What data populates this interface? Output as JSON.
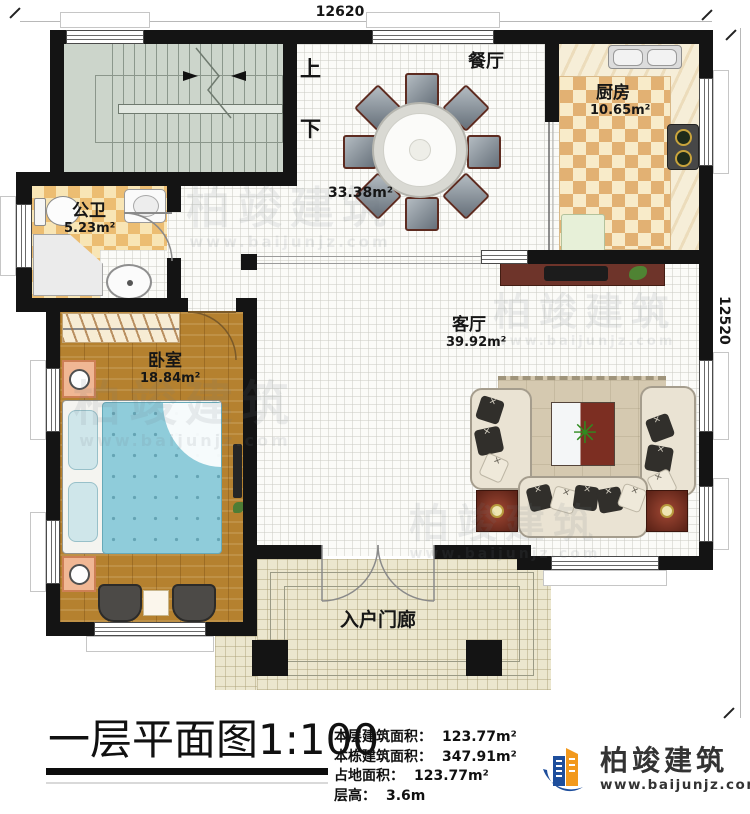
{
  "plan": {
    "dimensions": {
      "top": "12620",
      "right": "12520"
    },
    "stairs": {
      "up": "上",
      "down": "下"
    },
    "rooms": {
      "dining": {
        "name": "餐厅",
        "area": "33.38m²"
      },
      "kitchen": {
        "name": "厨房",
        "area": "10.65m²"
      },
      "bathroom": {
        "name": "公卫",
        "area": "5.23m²"
      },
      "bedroom": {
        "name": "卧室",
        "area": "18.84m²"
      },
      "living": {
        "name": "客厅",
        "area": "39.92m²"
      },
      "porch": {
        "name": "入户门廊"
      }
    }
  },
  "titleblock": {
    "title": "一层平面图",
    "scale": "1:100",
    "stats": [
      {
        "label": "本层建筑面积：",
        "value": "123.77m²"
      },
      {
        "label": "本栋建筑面积：",
        "value": "347.91m²"
      },
      {
        "label": "占地面积：",
        "value": "123.77m²"
      },
      {
        "label": "层高：",
        "value": "3.6m"
      }
    ],
    "logo": {
      "name": "柏竣建筑",
      "url": "www.baijunjz.com"
    }
  },
  "watermark": {
    "text": "柏竣建筑",
    "url": "www.baijunjz.com"
  },
  "colors": {
    "wall": "#141414",
    "logo_blue": "#1e4e9c",
    "logo_orange": "#f2991d",
    "bed": "#8fccda",
    "wood": "#b5812f"
  }
}
